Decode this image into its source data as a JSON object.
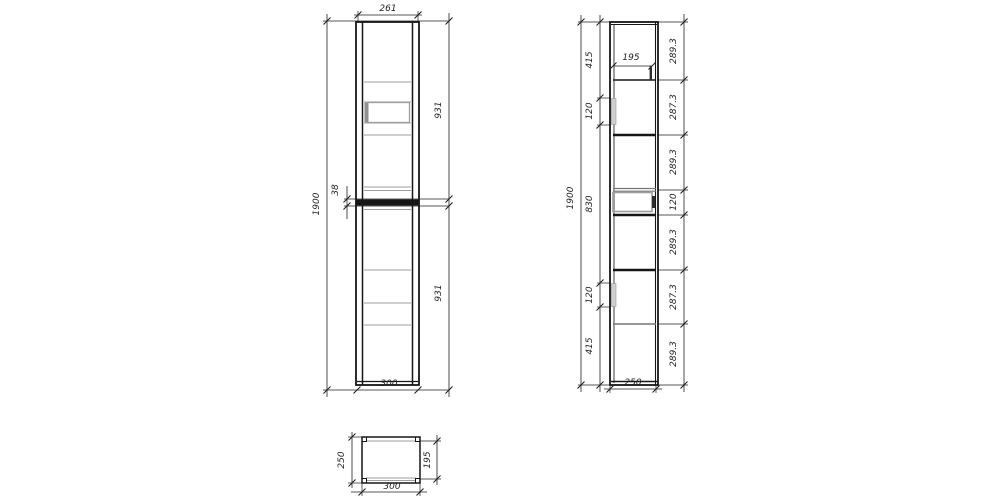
{
  "drawing_title": "cabinet-technical-drawing",
  "views": {
    "front": {
      "dims": {
        "width_top": "261",
        "height_total": "1900",
        "upper_section": "931",
        "divider": "38",
        "lower_section": "931",
        "width_bottom": "300"
      }
    },
    "side": {
      "dims": {
        "height_total": "1900",
        "left_sections": [
          "415",
          "120",
          "830",
          "120",
          "415"
        ],
        "right_sections": [
          "289.3",
          "287.3",
          "289.3",
          "120",
          "289.3",
          "287.3",
          "289.3"
        ],
        "shelf_inner": "195",
        "depth_bottom": "250"
      }
    },
    "plan": {
      "dims": {
        "depth": "250",
        "inner_depth": "195",
        "width": "300"
      }
    }
  }
}
